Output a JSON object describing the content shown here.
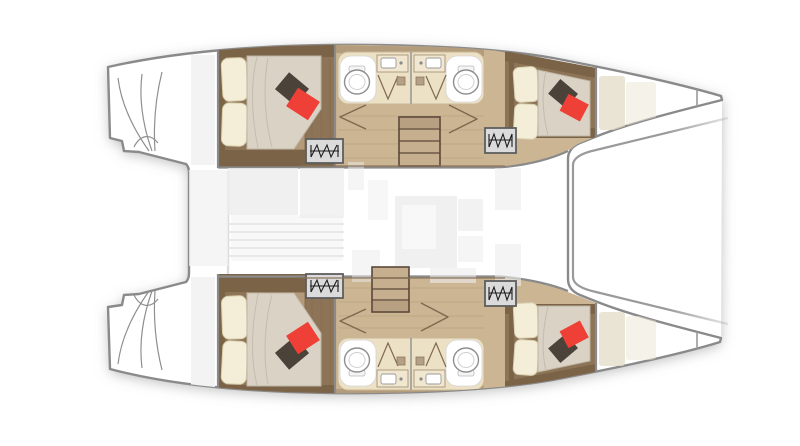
{
  "figure": {
    "subject": "catamaran yacht floor plan, top-down view, bows pointing right",
    "counts": {
      "double_berth_cabins": 4,
      "bathrooms": 4,
      "toilets": 4,
      "sink_counters": 4,
      "shower_doors": 4,
      "companionway_step_hatches": 4,
      "central_staircases": 2,
      "forepeak_berths": 2,
      "red_accent_pillows": 4,
      "dark_accent_pillows": 4,
      "transom_step_fans": 2
    }
  },
  "colors": {
    "hull-stroke": "#8a8a8a",
    "wood-dark": "#7b6347",
    "wood-cabin": "#8e7456",
    "wood-floor": "#ccb593",
    "wood-band": "#b39c7c",
    "bench": "#b49a79",
    "bath-floor": "#ece0c5",
    "bath-counter": "#f1e7d0",
    "mattress": "#d9d2c5",
    "mattress-line": "#bdb4a4",
    "pillow": "#f4eed8",
    "pillow-red": "#ee4036",
    "pillow-dark": "#4b423a",
    "steps-fill": "#dbdbdb",
    "steps-stroke": "#5e5e5e",
    "steps-glyph": "#1c1c1c",
    "stair-fill": "#c6af8f",
    "stair-dark": "#b7a081",
    "stair-stroke": "#5a4839",
    "door-line": "#7d6950",
    "fixture-stroke": "#8f8f8f",
    "faint": "#ececec",
    "faint2": "#f3f3f3"
  }
}
